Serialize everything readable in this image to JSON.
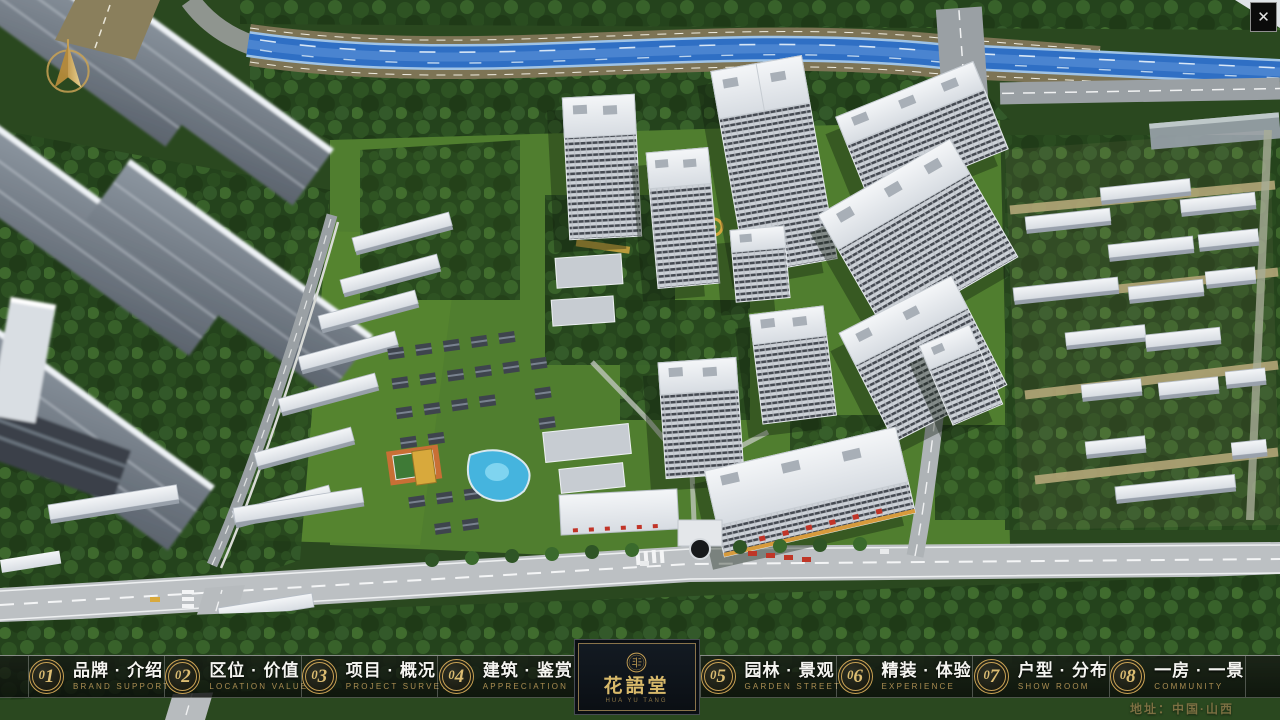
{
  "chrome": {
    "close_glyph": "✕"
  },
  "icons": {
    "compass": "compass-north-icon",
    "seal": "logo-seal-icon"
  },
  "menu": {
    "items": [
      {
        "num": "01",
        "zh": "品牌 · 介绍",
        "en": "BRAND SUPPORT"
      },
      {
        "num": "02",
        "zh": "区位 · 价值",
        "en": "LOCATION VALUE"
      },
      {
        "num": "03",
        "zh": "项目 · 概况",
        "en": "PROJECT SURVEY"
      },
      {
        "num": "04",
        "zh": "建筑 · 鉴赏",
        "en": "APPRECIATION"
      },
      {
        "num": "05",
        "zh": "园林 · 景观",
        "en": "GARDEN STREET"
      },
      {
        "num": "06",
        "zh": "精装 · 体验",
        "en": "EXPERIENCE"
      },
      {
        "num": "07",
        "zh": "户型 · 分布",
        "en": "SHOW ROOM"
      },
      {
        "num": "08",
        "zh": "一房 · 一景",
        "en": "COMMUNITY"
      }
    ]
  },
  "logo": {
    "title": "花語堂",
    "tagline": "HUA YU TANG"
  },
  "footer": {
    "address": "地址：中国·山西"
  },
  "colors": {
    "gold": "#c9a254",
    "gold_text": "#dcbd72",
    "en_text": "#ab8e52",
    "river": "#2f6fc4",
    "grass": "#507e2f",
    "road": "#bcc0c3",
    "address": "#7c7042"
  }
}
